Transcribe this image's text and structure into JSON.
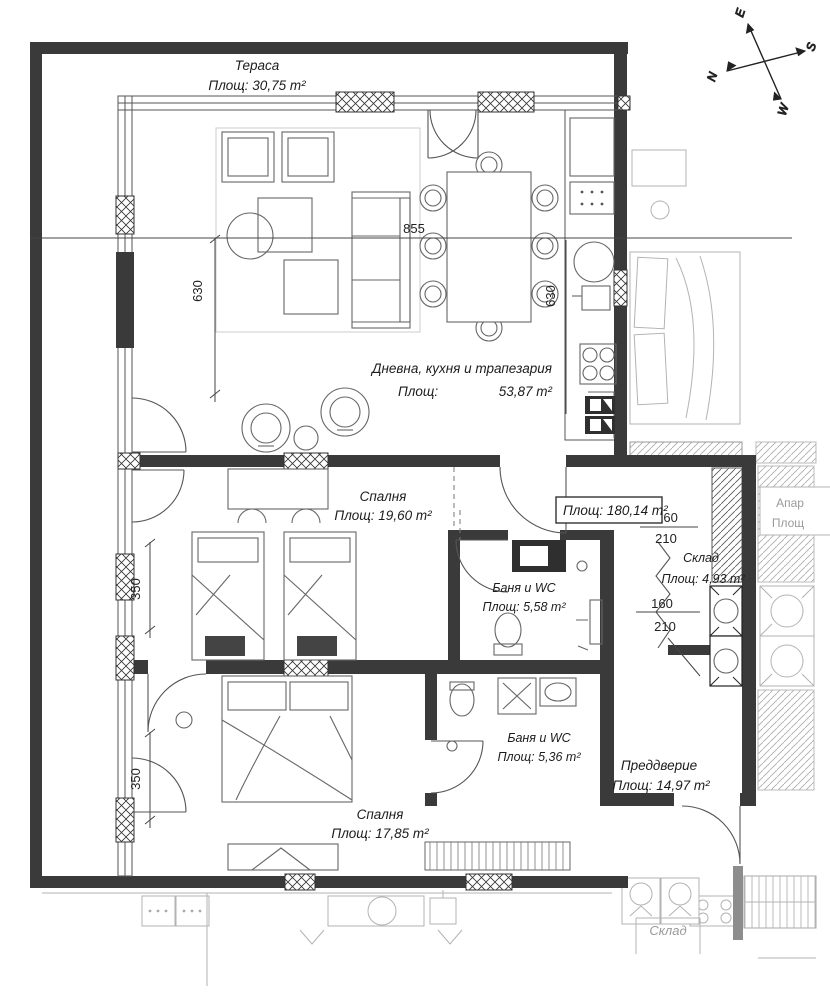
{
  "compass": {
    "n": "N",
    "s": "S",
    "e": "E",
    "w": "W"
  },
  "terrace": {
    "name": "Тераса",
    "area": "Площ: 30,75 m²"
  },
  "living": {
    "name": "Дневна, кухня и трапезария",
    "area_label": "Площ:",
    "area_value": "53,87 m²"
  },
  "bedroom1": {
    "name": "Спалня",
    "area": "Площ: 19,60 m²"
  },
  "bath1": {
    "name": "Баня и WC",
    "area": "Площ: 5,58 m²"
  },
  "storage": {
    "name": "Склад",
    "area": "Площ: 4,93 m²"
  },
  "bath2": {
    "name": "Баня и WC",
    "area": "Площ: 5,36 m²"
  },
  "hall": {
    "name": "Преддверие",
    "area": "Площ: 14,97 m²"
  },
  "bedroom2": {
    "name": "Спалня",
    "area": "Площ: 17,85 m²"
  },
  "total_area_box": {
    "label": "Площ: 180,14 m²"
  },
  "dimensions": {
    "width_top": "855",
    "height_living_left": "630",
    "height_kitchen": "630",
    "height_bed1": "350",
    "height_bed2": "350",
    "door_a_width": "160",
    "door_a_height": "210",
    "door_b_width": "160",
    "door_b_height": "210"
  },
  "adjacent": {
    "apartment_box_line1": "Апар",
    "apartment_box_line2": "Площ",
    "storage_label": "Склад"
  },
  "colors": {
    "wall": "#3a3a3a",
    "adjacent": "#b3b3b3",
    "compass_n": "#3b3bb4",
    "compass_s": "#b03a2a"
  }
}
